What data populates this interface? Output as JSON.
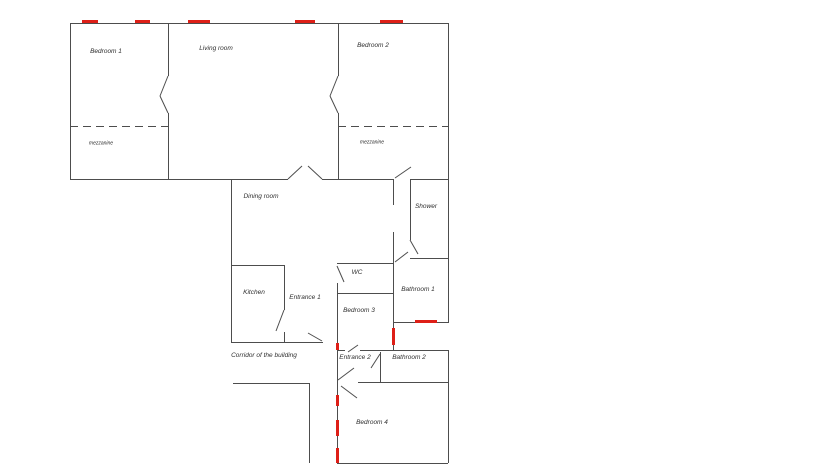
{
  "document": {
    "type": "apartment-floor-plan",
    "background": "#ffffff"
  },
  "colors": {
    "wall": "#4d4d4d",
    "window": "#de1f17",
    "label": "#2e2e2e"
  },
  "plan": {
    "labels": [
      {
        "id": "bedroom-1",
        "text": "Bedroom 1",
        "x": 106,
        "y": 52,
        "small": false
      },
      {
        "id": "living-room",
        "text": "Living room",
        "x": 216,
        "y": 49,
        "small": false
      },
      {
        "id": "bedroom-2",
        "text": "Bedroom 2",
        "x": 373,
        "y": 46,
        "small": false
      },
      {
        "id": "mezzanine-1",
        "text": "mezzanine",
        "x": 101,
        "y": 144,
        "small": true
      },
      {
        "id": "mezzanine-2",
        "text": "mezzanine",
        "x": 372,
        "y": 143,
        "small": true
      },
      {
        "id": "dining-room",
        "text": "Dining room",
        "x": 261,
        "y": 197,
        "small": false
      },
      {
        "id": "shower",
        "text": "Shower",
        "x": 426,
        "y": 207,
        "small": false
      },
      {
        "id": "kitchen",
        "text": "Kitchen",
        "x": 254,
        "y": 293,
        "small": false
      },
      {
        "id": "entrance-1",
        "text": "Entrance 1",
        "x": 305,
        "y": 298,
        "small": false
      },
      {
        "id": "wc",
        "text": "WC",
        "x": 357,
        "y": 273,
        "small": false
      },
      {
        "id": "bathroom-1",
        "text": "Bathroom 1",
        "x": 418,
        "y": 290,
        "small": false
      },
      {
        "id": "bedroom-3",
        "text": "Bedroom 3",
        "x": 359,
        "y": 311,
        "small": false
      },
      {
        "id": "corridor",
        "text": "Corridor of the building",
        "x": 264,
        "y": 356,
        "small": false
      },
      {
        "id": "entrance-2",
        "text": "Entrance 2",
        "x": 355,
        "y": 358,
        "small": false
      },
      {
        "id": "bathroom-2",
        "text": "Bathroom 2",
        "x": 409,
        "y": 358,
        "small": false
      },
      {
        "id": "bedroom-4",
        "text": "Bedroom 4",
        "x": 372,
        "y": 423,
        "small": false
      }
    ],
    "walls": [
      {
        "x": 70,
        "y": 23,
        "w": 378,
        "h": 1
      },
      {
        "x": 70,
        "y": 179,
        "w": 218,
        "h": 1
      },
      {
        "x": 322,
        "y": 179,
        "w": 72,
        "h": 1
      },
      {
        "x": 410,
        "y": 179,
        "w": 38,
        "h": 1
      },
      {
        "x": 231,
        "y": 265,
        "w": 53,
        "h": 1
      },
      {
        "x": 231,
        "y": 342,
        "w": 92,
        "h": 1
      },
      {
        "x": 410,
        "y": 258,
        "w": 39,
        "h": 1
      },
      {
        "x": 337,
        "y": 263,
        "w": 56,
        "h": 1
      },
      {
        "x": 337,
        "y": 293,
        "w": 56,
        "h": 1
      },
      {
        "x": 393,
        "y": 322,
        "w": 56,
        "h": 1
      },
      {
        "x": 337,
        "y": 350,
        "w": 8,
        "h": 1
      },
      {
        "x": 360,
        "y": 350,
        "w": 88,
        "h": 1
      },
      {
        "x": 358,
        "y": 382,
        "w": 90,
        "h": 1
      },
      {
        "x": 233,
        "y": 383,
        "w": 76,
        "h": 1
      },
      {
        "x": 337,
        "y": 463,
        "w": 111,
        "h": 1
      },
      {
        "x": 70,
        "y": 23,
        "w": 1,
        "h": 157
      },
      {
        "x": 168,
        "y": 23,
        "w": 1,
        "h": 53
      },
      {
        "x": 168,
        "y": 113,
        "w": 1,
        "h": 67
      },
      {
        "x": 338,
        "y": 23,
        "w": 1,
        "h": 53
      },
      {
        "x": 338,
        "y": 113,
        "w": 1,
        "h": 67
      },
      {
        "x": 448,
        "y": 23,
        "w": 1,
        "h": 300
      },
      {
        "x": 231,
        "y": 179,
        "w": 1,
        "h": 164
      },
      {
        "x": 284,
        "y": 265,
        "w": 1,
        "h": 45
      },
      {
        "x": 284,
        "y": 332,
        "w": 1,
        "h": 11
      },
      {
        "x": 337,
        "y": 283,
        "w": 1,
        "h": 60
      },
      {
        "x": 337,
        "y": 342,
        "w": 1,
        "h": 8
      },
      {
        "x": 337,
        "y": 350,
        "w": 1,
        "h": 32
      },
      {
        "x": 337,
        "y": 382,
        "w": 1,
        "h": 81
      },
      {
        "x": 393,
        "y": 179,
        "w": 1,
        "h": 26
      },
      {
        "x": 393,
        "y": 232,
        "w": 1,
        "h": 118
      },
      {
        "x": 410,
        "y": 179,
        "w": 1,
        "h": 61
      },
      {
        "x": 380,
        "y": 352,
        "w": 1,
        "h": 30
      },
      {
        "x": 448,
        "y": 350,
        "w": 1,
        "h": 113
      },
      {
        "x": 309,
        "y": 383,
        "w": 1,
        "h": 80
      }
    ],
    "dashed_lines": [
      {
        "x": 70,
        "y": 126,
        "w": 98
      },
      {
        "x": 338,
        "y": 126,
        "w": 110
      }
    ],
    "windows": [
      {
        "x": 82,
        "y": 20,
        "w": 16,
        "h": 3
      },
      {
        "x": 135,
        "y": 20,
        "w": 15,
        "h": 3
      },
      {
        "x": 188,
        "y": 20,
        "w": 22,
        "h": 3
      },
      {
        "x": 295,
        "y": 20,
        "w": 20,
        "h": 3
      },
      {
        "x": 380,
        "y": 20,
        "w": 23,
        "h": 3
      },
      {
        "x": 415,
        "y": 320,
        "w": 22,
        "h": 3
      },
      {
        "x": 392,
        "y": 328,
        "w": 3,
        "h": 17
      },
      {
        "x": 336,
        "y": 343,
        "w": 3,
        "h": 7
      },
      {
        "x": 336,
        "y": 395,
        "w": 3,
        "h": 11
      },
      {
        "x": 336,
        "y": 420,
        "w": 3,
        "h": 16
      },
      {
        "x": 336,
        "y": 448,
        "w": 3,
        "h": 15
      }
    ],
    "doors": [
      {
        "x1": 168,
        "y1": 76,
        "x2": 160,
        "y2": 96
      },
      {
        "x1": 160,
        "y1": 96,
        "x2": 168,
        "y2": 113
      },
      {
        "x1": 338,
        "y1": 76,
        "x2": 330,
        "y2": 96
      },
      {
        "x1": 330,
        "y1": 96,
        "x2": 338,
        "y2": 113
      },
      {
        "x1": 288,
        "y1": 179,
        "x2": 302,
        "y2": 166
      },
      {
        "x1": 322,
        "y1": 179,
        "x2": 308,
        "y2": 166
      },
      {
        "x1": 395,
        "y1": 178,
        "x2": 411,
        "y2": 167
      },
      {
        "x1": 410,
        "y1": 240,
        "x2": 418,
        "y2": 254
      },
      {
        "x1": 395,
        "y1": 262,
        "x2": 408,
        "y2": 252
      },
      {
        "x1": 337,
        "y1": 266,
        "x2": 344,
        "y2": 282
      },
      {
        "x1": 284,
        "y1": 310,
        "x2": 276,
        "y2": 331
      },
      {
        "x1": 308,
        "y1": 333,
        "x2": 322,
        "y2": 341
      },
      {
        "x1": 348,
        "y1": 352,
        "x2": 358,
        "y2": 345
      },
      {
        "x1": 380,
        "y1": 354,
        "x2": 371,
        "y2": 368
      },
      {
        "x1": 338,
        "y1": 380,
        "x2": 354,
        "y2": 368
      },
      {
        "x1": 341,
        "y1": 386,
        "x2": 357,
        "y2": 398
      }
    ]
  }
}
